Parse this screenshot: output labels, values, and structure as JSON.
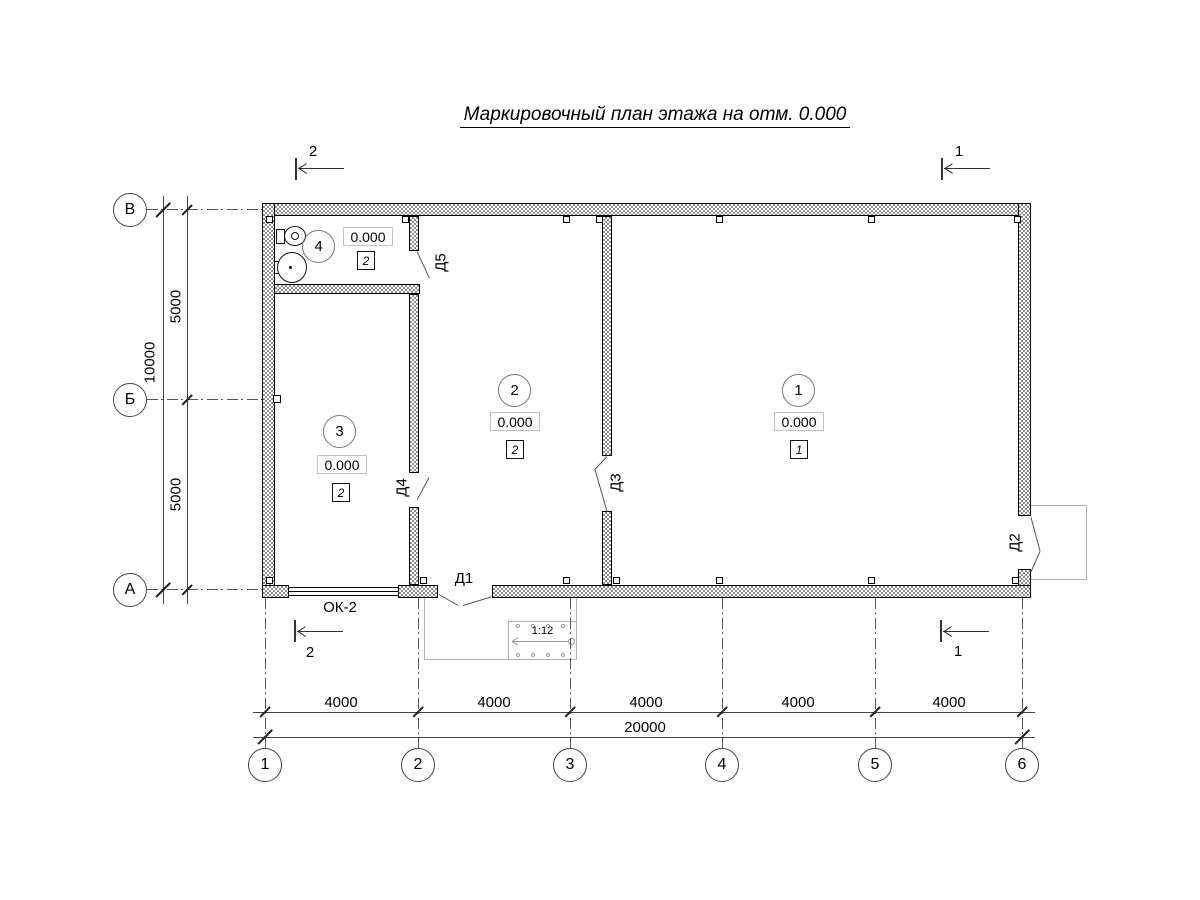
{
  "title": "Маркировочный план этажа на отм. 0.000",
  "axes": {
    "vertical": [
      "В",
      "Б",
      "А"
    ],
    "horizontal": [
      "1",
      "2",
      "3",
      "4",
      "5",
      "6"
    ]
  },
  "dimensions": {
    "left_spans": [
      "5000",
      "5000"
    ],
    "left_total": "10000",
    "bottom_spans": [
      "4000",
      "4000",
      "4000",
      "4000",
      "4000"
    ],
    "bottom_total": "20000"
  },
  "rooms": [
    {
      "number": "1",
      "elevation": "0.000",
      "type": "1"
    },
    {
      "number": "2",
      "elevation": "0.000",
      "type": "2"
    },
    {
      "number": "3",
      "elevation": "0.000",
      "type": "2"
    },
    {
      "number": "4",
      "elevation": "0.000",
      "type": "2"
    }
  ],
  "doors": [
    {
      "label": "Д1"
    },
    {
      "label": "Д2"
    },
    {
      "label": "Д3"
    },
    {
      "label": "Д4"
    },
    {
      "label": "Д5"
    }
  ],
  "window": {
    "label": "ОК-2"
  },
  "ramp": {
    "slope": "1:12"
  },
  "section_marks": [
    {
      "label": "2",
      "position": "top-left"
    },
    {
      "label": "1",
      "position": "top-right"
    },
    {
      "label": "2",
      "position": "bottom-left"
    },
    {
      "label": "1",
      "position": "bottom-right"
    }
  ],
  "colors": {
    "line": "#000000",
    "wall_hatch": "#8f8f8f",
    "axis_line": "#555555",
    "porch_line": "#b0b0b0"
  }
}
